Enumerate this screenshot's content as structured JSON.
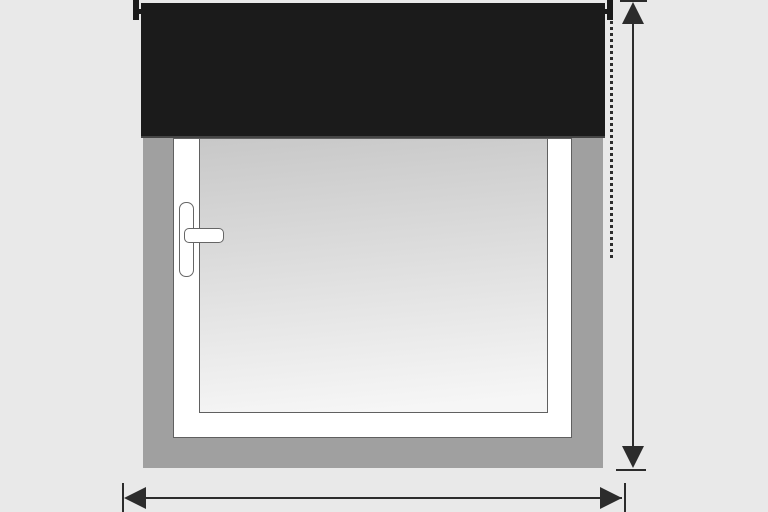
{
  "diagram": {
    "subject": "roller-blind-mounted-above-window-measurement-guide",
    "text": {},
    "parts": [
      "roller-blind",
      "blind-mounting-bracket-left",
      "blind-mounting-bracket-right",
      "window-recess-wall",
      "window-frame",
      "window-glass",
      "window-handle",
      "blind-drop-dotted-line",
      "height-measurement-arrow",
      "width-measurement-arrow"
    ],
    "colors": {
      "background": "#e9e9e9",
      "wall": "#a0a0a0",
      "blind": "#1b1b1b",
      "blind_edge": "#454545",
      "frame": "#ffffff",
      "frame_outline": "#606060",
      "glass_top": "#c8c8c8",
      "glass_bottom": "#f6f6f6",
      "handle_fill": "#ffffff",
      "handle_outline": "#666666",
      "line": "#2c2c2c"
    }
  }
}
